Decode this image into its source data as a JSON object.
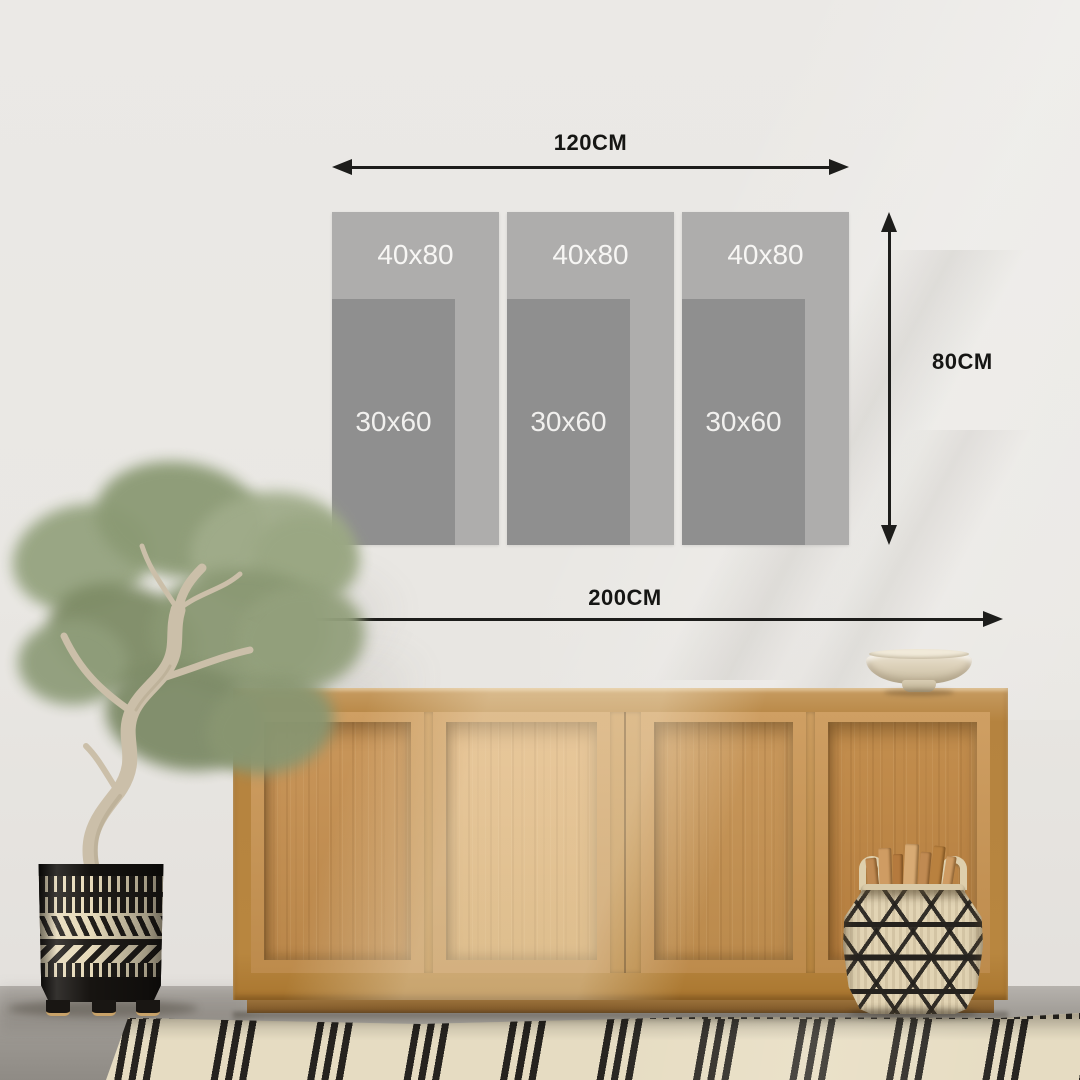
{
  "artwork_diagram": {
    "top_width_label": "120CM",
    "side_height_label": "80CM",
    "bottom_width_label": "200CM",
    "panels": [
      {
        "outer_size": "40x80",
        "inner_size": "30x60"
      },
      {
        "outer_size": "40x80",
        "inner_size": "30x60"
      },
      {
        "outer_size": "40x80",
        "inner_size": "30x60"
      }
    ],
    "colors": {
      "outer_panel_gray": "#aeadac",
      "inner_panel_gray": "#8f8f8f",
      "size_label_text": "#f7f6f4",
      "dimension_line": "#1d1d1b"
    }
  },
  "scene": {
    "wall_color": "#e9e7e3",
    "floor_color": "#99958f",
    "sideboard_wood_color": "#c1914f",
    "rug": {
      "base_color": "#e6dcc2",
      "stripe_color": "#26231f"
    },
    "planter": {
      "base_color": "#201d19",
      "pattern_color": "#e7dbbb"
    },
    "basket": {
      "base_color": "#e2d4b4",
      "pattern_color": "#25221e"
    },
    "bowl_color": "#e3dac6"
  }
}
